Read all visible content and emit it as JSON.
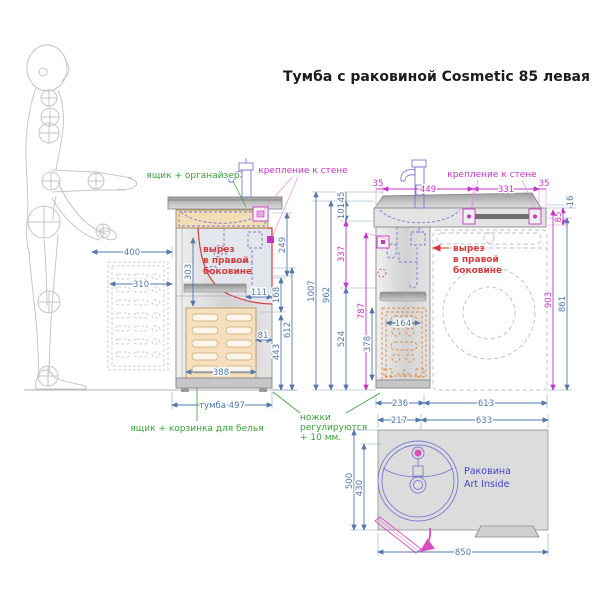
{
  "title": "Тумба с раковиной Cosmetic 85 левая",
  "colors": {
    "dimension_blue": "#5577aa",
    "magenta": "#c535c5",
    "green": "#3aa03a",
    "red": "#d43d3d",
    "plumbing_violet": "#7a7ad0",
    "basket_orange": "#e0883a",
    "sink_text_blue": "#4545cc"
  },
  "side_view": {
    "label_drawer_organizer": "ящик + органайзер",
    "label_wall_mount": "крепление к стене",
    "cutout_line1": "вырез",
    "cutout_line2": "в правой",
    "cutout_line3": "боковине",
    "label_basket": "ящик + корзинка для белья",
    "dim_cabinet": "тумба 497",
    "dim_400": "400",
    "dim_310": "310",
    "dim_303": "303",
    "dim_249": "249",
    "dim_168": "168",
    "dim_111": "111",
    "dim_612": "612",
    "dim_443": "443",
    "dim_81": "81",
    "dim_388": "388"
  },
  "front_view": {
    "label_wall_mount": "крепление к стене",
    "cutout_line1": "вырез",
    "cutout_line2": "в правой",
    "cutout_line3": "боковине",
    "legs_line1": "ножки",
    "legs_line2": "регулируются",
    "legs_line3": "+ 10 мм.",
    "dim_35_left": "35",
    "dim_449": "449",
    "dim_331": "331",
    "dim_35_right": "35",
    "dim_45": "45",
    "dim_101": "101",
    "dim_1007": "1007",
    "dim_962": "962",
    "dim_337": "337",
    "dim_524": "524",
    "dim_787": "787",
    "dim_378": "378",
    "dim_164": "164",
    "dim_16": "16",
    "dim_85": "85",
    "dim_903": "903",
    "dim_861": "861",
    "dim_236": "236",
    "dim_613": "613"
  },
  "top_view": {
    "sink_line1": "Раковина",
    "sink_line2": "Art Inside",
    "dim_217": "217",
    "dim_633": "633",
    "dim_500": "500",
    "dim_430": "430",
    "dim_850": "850"
  }
}
